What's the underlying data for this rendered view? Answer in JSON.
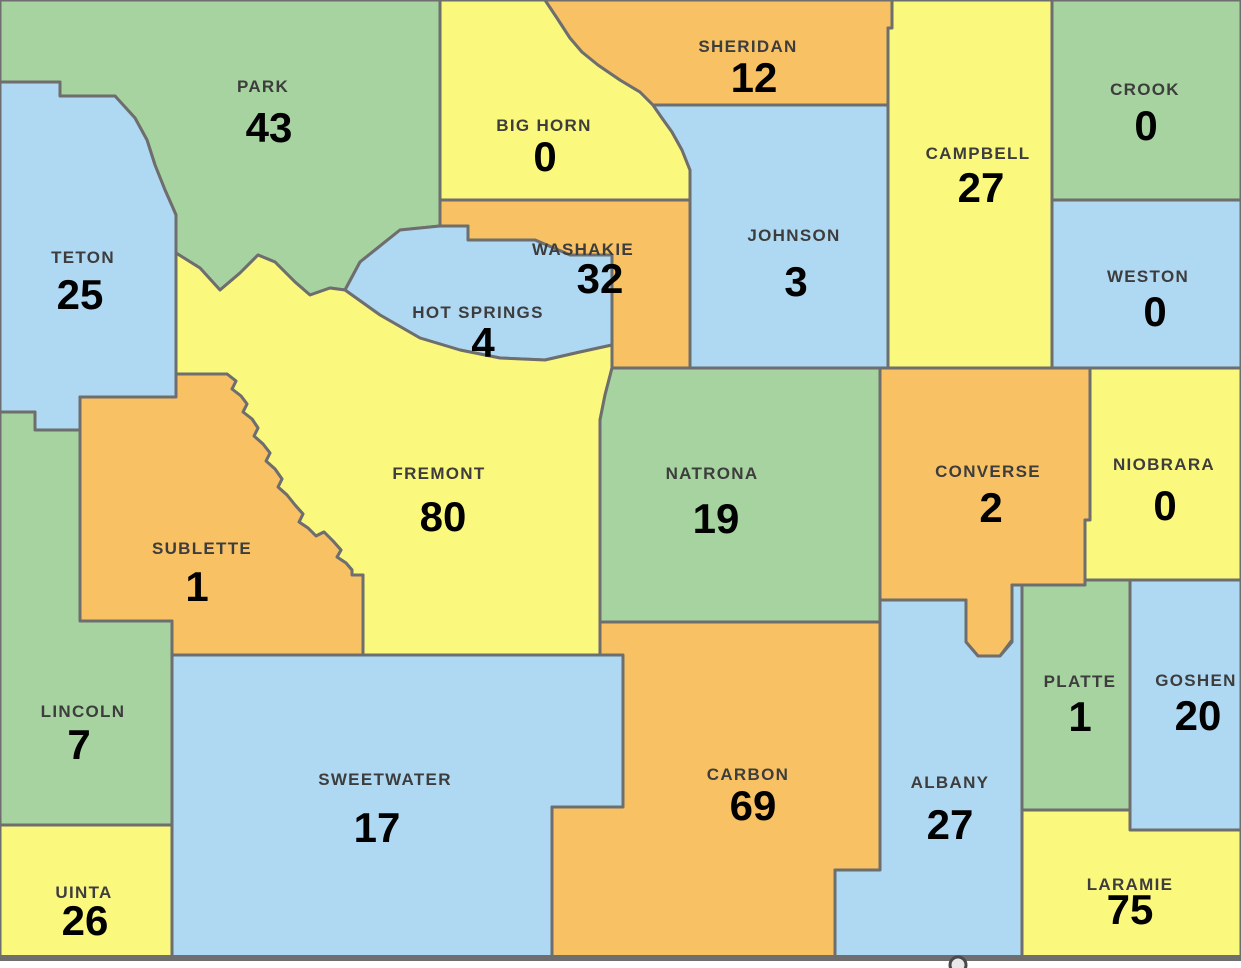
{
  "map_title": "Wyoming counties map",
  "palette": {
    "green": "#A6D3A0",
    "blue": "#AFD8F3",
    "yellow": "#FBF87E",
    "orange": "#F8C264",
    "border": "#6E6E6E",
    "name_text": "#3D3D3D",
    "value_text": "#000000"
  },
  "counties": [
    {
      "id": "park",
      "name": "PARK",
      "value": "43",
      "color": "green"
    },
    {
      "id": "big-horn",
      "name": "BIG HORN",
      "value": "0",
      "color": "yellow"
    },
    {
      "id": "sheridan",
      "name": "SHERIDAN",
      "value": "12",
      "color": "orange"
    },
    {
      "id": "campbell",
      "name": "CAMPBELL",
      "value": "27",
      "color": "yellow"
    },
    {
      "id": "crook",
      "name": "CROOK",
      "value": "0",
      "color": "green"
    },
    {
      "id": "weston",
      "name": "WESTON",
      "value": "0",
      "color": "blue"
    },
    {
      "id": "johnson",
      "name": "JOHNSON",
      "value": "3",
      "color": "blue"
    },
    {
      "id": "teton",
      "name": "TETON",
      "value": "25",
      "color": "blue"
    },
    {
      "id": "washakie",
      "name": "WASHAKIE",
      "value": "32",
      "color": "orange"
    },
    {
      "id": "hot-springs",
      "name": "HOT SPRINGS",
      "value": "4",
      "color": "blue"
    },
    {
      "id": "fremont",
      "name": "FREMONT",
      "value": "80",
      "color": "yellow"
    },
    {
      "id": "natrona",
      "name": "NATRONA",
      "value": "19",
      "color": "green"
    },
    {
      "id": "converse",
      "name": "CONVERSE",
      "value": "2",
      "color": "orange"
    },
    {
      "id": "niobrara",
      "name": "NIOBRARA",
      "value": "0",
      "color": "yellow"
    },
    {
      "id": "sublette",
      "name": "SUBLETTE",
      "value": "1",
      "color": "orange"
    },
    {
      "id": "lincoln",
      "name": "LINCOLN",
      "value": "7",
      "color": "green"
    },
    {
      "id": "uinta",
      "name": "UINTA",
      "value": "26",
      "color": "yellow"
    },
    {
      "id": "sweetwater",
      "name": "SWEETWATER",
      "value": "17",
      "color": "blue"
    },
    {
      "id": "carbon",
      "name": "CARBON",
      "value": "69",
      "color": "orange"
    },
    {
      "id": "albany",
      "name": "ALBANY",
      "value": "27",
      "color": "blue"
    },
    {
      "id": "platte",
      "name": "PLATTE",
      "value": "1",
      "color": "green"
    },
    {
      "id": "goshen",
      "name": "GOSHEN",
      "value": "20",
      "color": "blue"
    },
    {
      "id": "laramie",
      "name": "LARAMIE",
      "value": "75",
      "color": "yellow"
    }
  ]
}
